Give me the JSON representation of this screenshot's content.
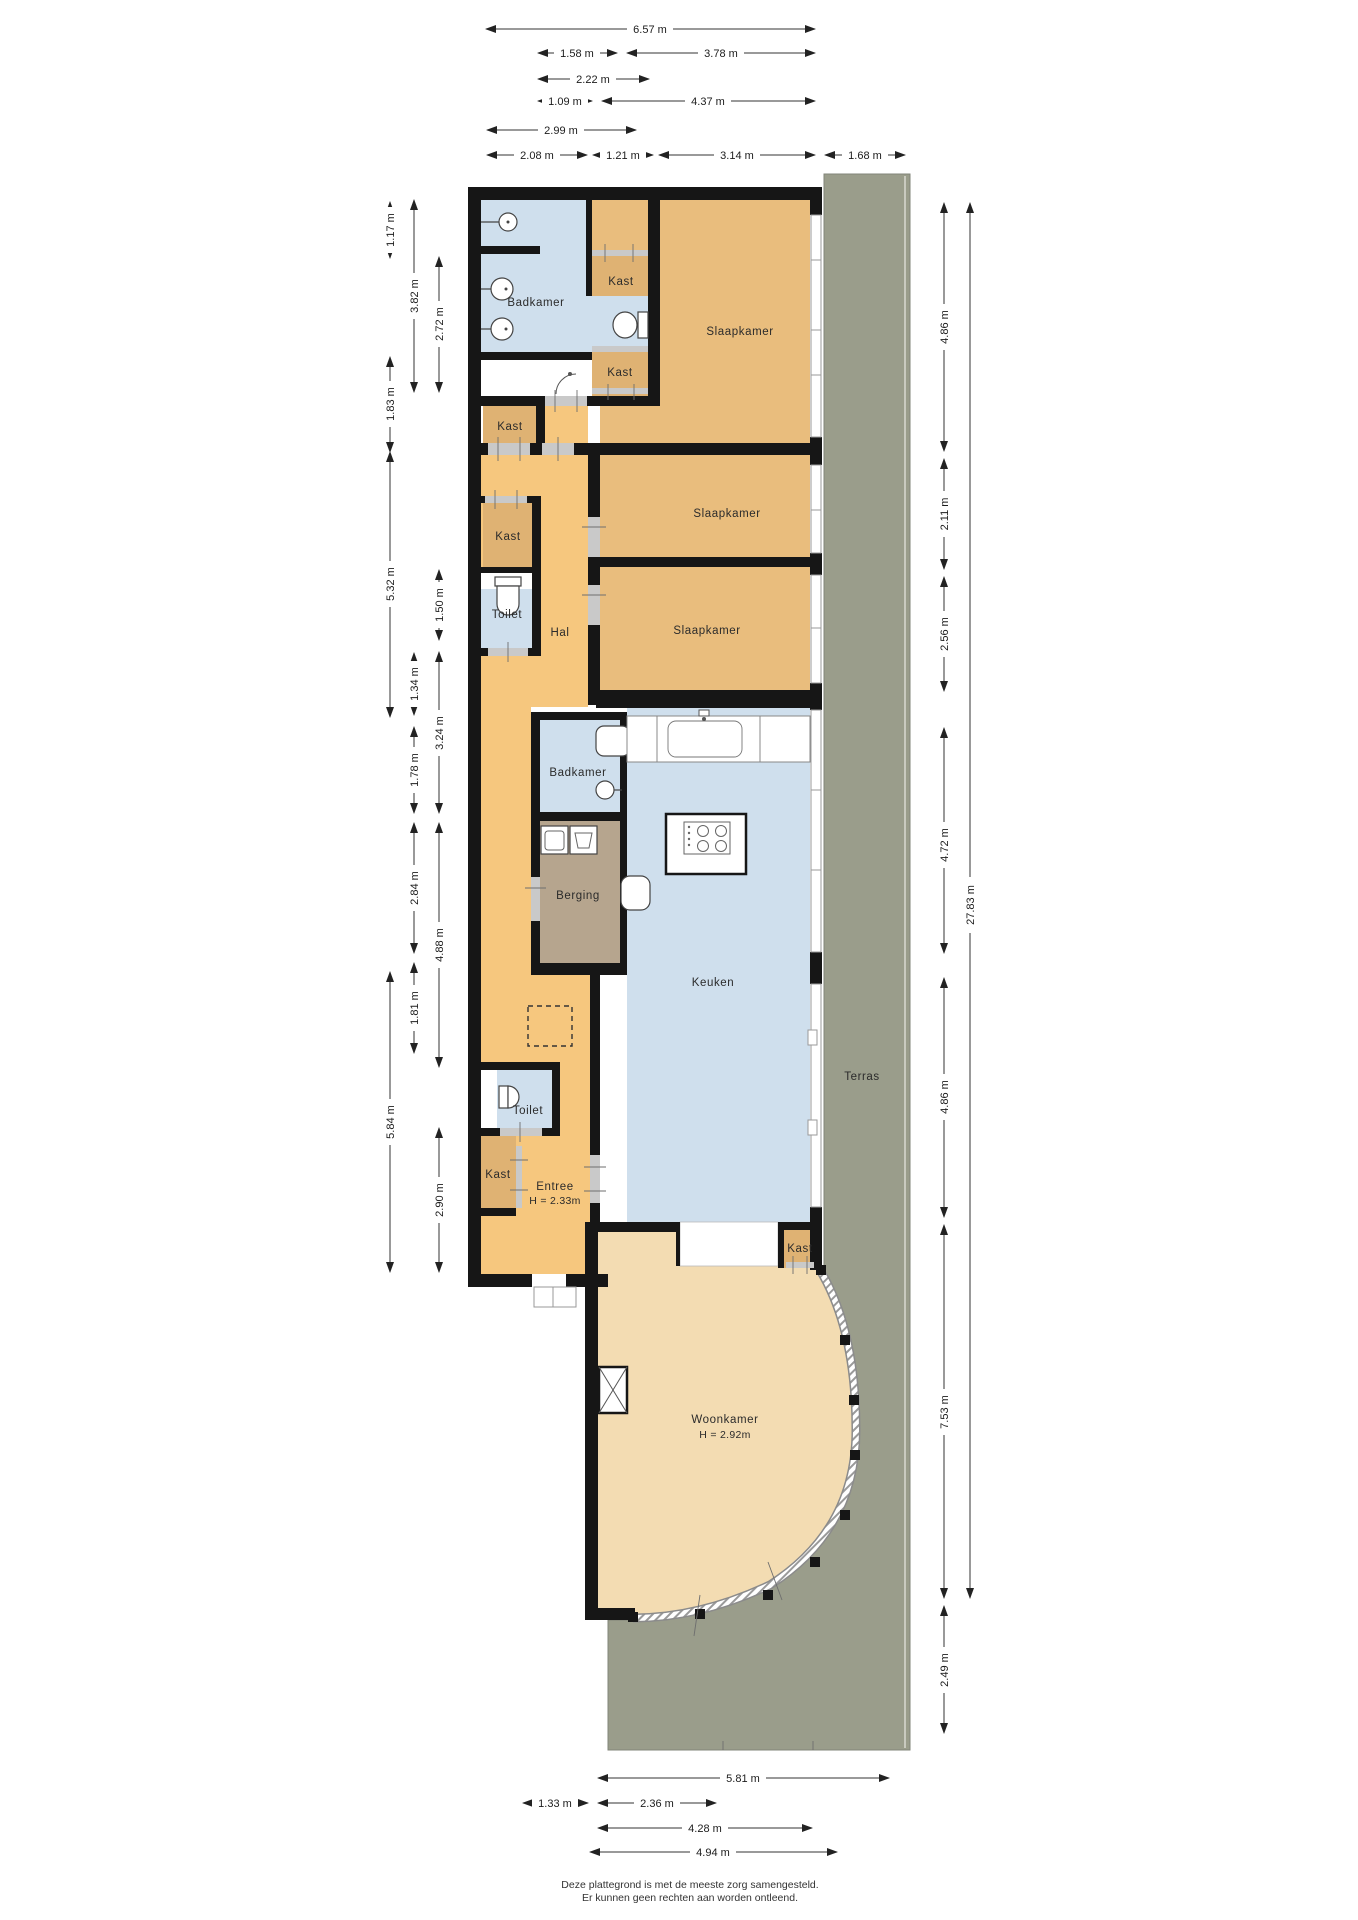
{
  "rooms": {
    "badkamer_boven": {
      "label": "Badkamer"
    },
    "kast_1": {
      "label": "Kast"
    },
    "kast_2": {
      "label": "Kast"
    },
    "kast_3": {
      "label": "Kast"
    },
    "kast_4": {
      "label": "Kast"
    },
    "kast_5": {
      "label": "Kast"
    },
    "kast_6": {
      "label": "Kast"
    },
    "slaapkamer_1": {
      "label": "Slaapkamer"
    },
    "slaapkamer_2": {
      "label": "Slaapkamer"
    },
    "slaapkamer_3": {
      "label": "Slaapkamer"
    },
    "toilet_boven": {
      "label": "Toilet"
    },
    "toilet_onder": {
      "label": "Toilet"
    },
    "hal": {
      "label": "Hal"
    },
    "badkamer_midden": {
      "label": "Badkamer"
    },
    "berging": {
      "label": "Berging"
    },
    "keuken": {
      "label": "Keuken"
    },
    "entree": {
      "label": "Entree",
      "height": "H = 2.33m"
    },
    "woonkamer": {
      "label": "Woonkamer",
      "height": "H = 2.92m"
    },
    "terras": {
      "label": "Terras"
    }
  },
  "dims": {
    "top": [
      {
        "label": "6.57 m"
      },
      {
        "label": "1.58 m"
      },
      {
        "label": "3.78 m"
      },
      {
        "label": "2.22 m"
      },
      {
        "label": "1.09 m"
      },
      {
        "label": "4.37 m"
      },
      {
        "label": "2.99 m"
      },
      {
        "label": "2.08 m"
      },
      {
        "label": "1.21 m"
      },
      {
        "label": "3.14 m"
      },
      {
        "label": "1.68 m"
      }
    ],
    "left": [
      {
        "label": "1.17 m"
      },
      {
        "label": "3.82 m"
      },
      {
        "label": "2.72 m"
      },
      {
        "label": "1.83 m"
      },
      {
        "label": "5.32 m"
      },
      {
        "label": "1.50 m"
      },
      {
        "label": "1.34 m"
      },
      {
        "label": "3.24 m"
      },
      {
        "label": "1.78 m"
      },
      {
        "label": "2.84 m"
      },
      {
        "label": "4.88 m"
      },
      {
        "label": "1.81 m"
      },
      {
        "label": "5.84 m"
      },
      {
        "label": "2.90 m"
      }
    ],
    "right": [
      {
        "label": "4.86 m"
      },
      {
        "label": "2.11 m"
      },
      {
        "label": "2.56 m"
      },
      {
        "label": "4.72 m"
      },
      {
        "label": "4.86 m"
      },
      {
        "label": "7.53 m"
      },
      {
        "label": "2.49 m"
      },
      {
        "label": "27.83 m"
      }
    ],
    "bottom": [
      {
        "label": "5.81 m"
      },
      {
        "label": "1.33 m"
      },
      {
        "label": "2.36 m"
      },
      {
        "label": "4.28 m"
      },
      {
        "label": "4.94 m"
      }
    ]
  },
  "disclaimer": {
    "line1": "Deze plattegrond is met de meeste zorg samengesteld.",
    "line2": "Er kunnen geen rechten aan worden ontleend."
  },
  "colors": {
    "hall_orange": "#f6c77e",
    "bedroom_orange": "#e9bd7d",
    "closet_tan": "#dfb273",
    "storage_brown": "#b6a58e",
    "wet_blue": "#cfdfed",
    "living_beige": "#f3dcb2",
    "terrace_green": "#9a9d8b",
    "wall_black": "#161616"
  }
}
